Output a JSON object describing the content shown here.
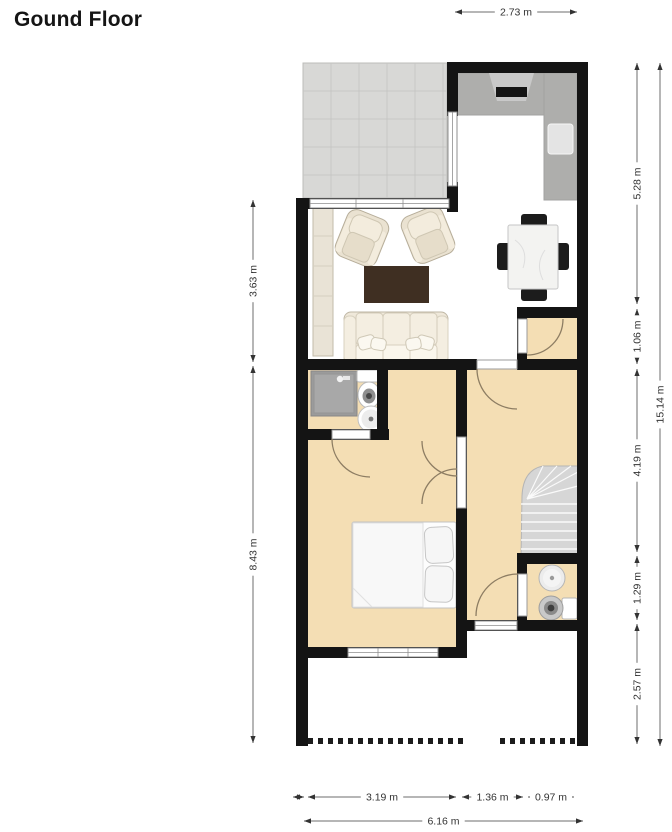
{
  "title": "Gound Floor",
  "unit": "m",
  "colors": {
    "wall": "#141414",
    "floor_room": "#f4deb4",
    "terrace_tile": "#d8d8d6",
    "terrace_grout": "#c7c7c5",
    "counter": "#aeaeac",
    "hood": "#c9c9c9",
    "stairs": "#d6d6d6",
    "rug": "#3f2f22",
    "dim_line": "#6e6e6e",
    "dim_arrow": "#333333",
    "dim_text": "#333333",
    "door_arc": "#8d7d63"
  },
  "dimensions": {
    "top_width": "2.73 m",
    "left_upper": "3.63 m",
    "left_lower": "8.43 m",
    "right_seg_1": "5.28 m",
    "right_seg_2": "1.06 m",
    "right_seg_3": "4.19 m",
    "right_seg_4": "1.29 m",
    "right_seg_5": "2.57 m",
    "right_total": "15.14 m",
    "bottom_seg_1": "3.19 m",
    "bottom_seg_2": "1.36 m",
    "bottom_seg_3": "0.97 m",
    "bottom_total": "6.16 m"
  },
  "dimension_lines": [
    {
      "id": "top-width",
      "label": "2.73 m",
      "orient": "h",
      "x1": 455,
      "x2": 577,
      "y": 12
    },
    {
      "id": "left-upper",
      "label": "3.63 m",
      "orient": "v",
      "x": 253,
      "y1": 200,
      "y2": 362
    },
    {
      "id": "left-lower",
      "label": "8.43 m",
      "orient": "v",
      "x": 253,
      "y1": 366,
      "y2": 743
    },
    {
      "id": "right-seg-1",
      "label": "5.28 m",
      "orient": "v",
      "x": 637,
      "y1": 63,
      "y2": 304
    },
    {
      "id": "right-seg-2",
      "label": "1.06 m",
      "orient": "v",
      "x": 637,
      "y1": 309,
      "y2": 364
    },
    {
      "id": "right-seg-3",
      "label": "4.19 m",
      "orient": "v",
      "x": 637,
      "y1": 369,
      "y2": 552
    },
    {
      "id": "right-seg-4",
      "label": "1.29 m",
      "orient": "v",
      "x": 637,
      "y1": 556,
      "y2": 620
    },
    {
      "id": "right-seg-5",
      "label": "2.57 m",
      "orient": "v",
      "x": 637,
      "y1": 624,
      "y2": 744
    },
    {
      "id": "right-total",
      "label": "15.14 m",
      "orient": "v",
      "x": 660,
      "y1": 63,
      "y2": 746
    },
    {
      "id": "bottom-seg-1",
      "label": "3.19 m",
      "orient": "h",
      "x1": 308,
      "x2": 456,
      "y": 797
    },
    {
      "id": "bottom-seg-2",
      "label": "1.36 m",
      "orient": "h",
      "x1": 462,
      "x2": 523,
      "y": 797
    },
    {
      "id": "bottom-seg-3",
      "label": "0.97 m",
      "orient": "h",
      "x1": 528,
      "x2": 574,
      "y": 797
    },
    {
      "id": "bottom-wall-tick",
      "label": "",
      "orient": "h",
      "x1": 293,
      "x2": 304,
      "y": 797
    },
    {
      "id": "bottom-total",
      "label": "6.16 m",
      "orient": "h",
      "x1": 304,
      "x2": 583,
      "y": 821
    }
  ]
}
